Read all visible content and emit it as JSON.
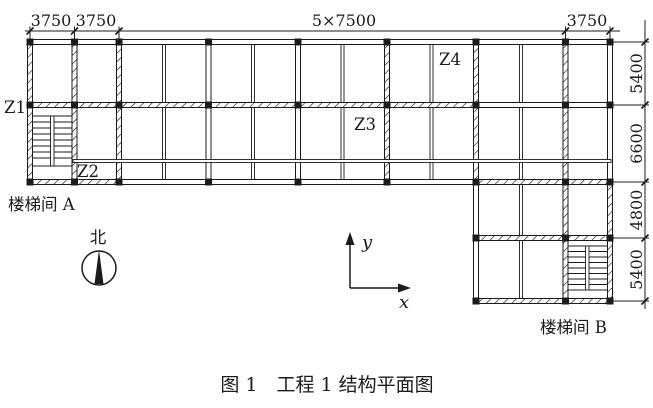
{
  "diagram": {
    "caption": "图 1　工程 1 结构平面图",
    "column_labels": {
      "z1": "Z1",
      "z2": "Z2",
      "z3": "Z3",
      "z4": "Z4"
    },
    "stairwell_a": "楼梯间 A",
    "stairwell_b": "楼梯间 B",
    "north_label": "北",
    "axis_labels": {
      "x": "x",
      "y": "y"
    },
    "dimensions_top": [
      "3750",
      "3750",
      "5×7500",
      "3750"
    ],
    "dimensions_right": [
      "5400",
      "6600",
      "4800",
      "5400"
    ],
    "colors": {
      "line": "#1b1b1b",
      "background": "#ffffff"
    }
  }
}
